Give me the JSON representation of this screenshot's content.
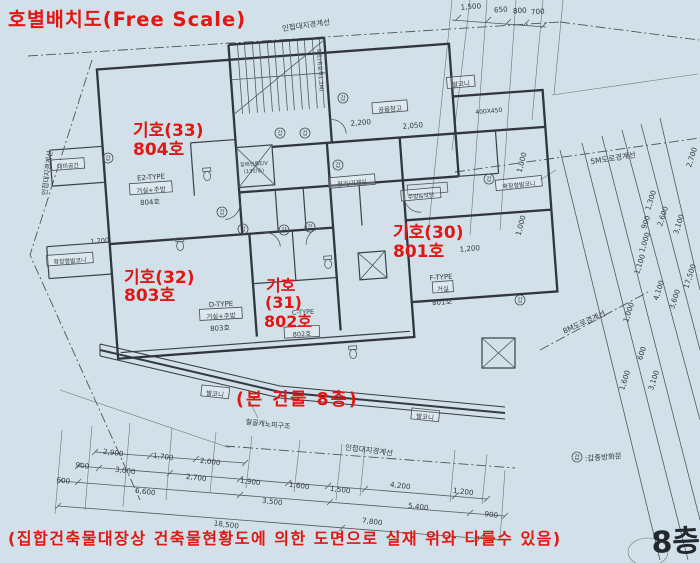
{
  "page": {
    "title": "호별배치도(Free Scale)",
    "floor_stamp": "8층",
    "disclaimer": "(집합건축물대장상 건축물현황도에 의한 도면으로 실재 위와 다를수 있음)",
    "building_note": "(본 건물 8층)",
    "colors": {
      "background": "#d2e0e9",
      "ink": "#30363c",
      "red": "#e01713"
    }
  },
  "red_notes": {
    "unit33": {
      "lines": [
        "기호(33)",
        "804호"
      ]
    },
    "unit30": {
      "lines": [
        "기호(30)",
        "801호"
      ]
    },
    "unit32": {
      "lines": [
        "기호(32)",
        "803호"
      ]
    },
    "unit31": {
      "lines": [
        "기호",
        "(31)",
        "802호"
      ]
    }
  },
  "site": {
    "legend_mark": "갑",
    "legend_text": ":갑종방화문",
    "door_mark": "갑"
  },
  "generated": {
    "labels": [
      {
        "t": "발코니",
        "x": 461,
        "y": 84,
        "r": -5,
        "box": 1,
        "fs": 6.5
      },
      {
        "t": "발코니",
        "x": 215,
        "y": 394,
        "r": 6,
        "box": 1,
        "fs": 6.5
      },
      {
        "t": "발코니",
        "x": 425,
        "y": 417,
        "r": 6,
        "box": 1,
        "fs": 6.5
      },
      {
        "t": "공용창고",
        "x": 390,
        "y": 109,
        "r": -5,
        "box": 1,
        "fs": 6.5
      },
      {
        "t": "대피공간",
        "x": 68,
        "y": 166,
        "r": -4,
        "box": 1,
        "fs": 6
      },
      {
        "t": "확장형발코니",
        "x": 70,
        "y": 261,
        "r": -4,
        "box": 1,
        "fs": 6
      },
      {
        "t": "확장형발코니",
        "x": 519,
        "y": 185,
        "r": -6,
        "box": 1,
        "fs": 6
      },
      {
        "t": "주방&식당",
        "x": 421,
        "y": 196,
        "r": -5,
        "box": 1,
        "fs": 6
      },
      {
        "t": "전기/기계실",
        "x": 352,
        "y": 183,
        "r": -5,
        "box": 1,
        "fs": 6
      },
      {
        "t": "E2-TYPE",
        "x": 151,
        "y": 177,
        "r": -4,
        "fs": 7
      },
      {
        "t": "거실+주방",
        "x": 151,
        "y": 190,
        "r": -4,
        "box": 1,
        "fs": 6.5
      },
      {
        "t": "804호",
        "x": 150,
        "y": 202,
        "r": -4,
        "fs": 7
      },
      {
        "t": "D-TYPE",
        "x": 221,
        "y": 304,
        "r": -3,
        "fs": 7
      },
      {
        "t": "거실+주방",
        "x": 221,
        "y": 316,
        "r": -3,
        "box": 1,
        "fs": 6.5
      },
      {
        "t": "803호",
        "x": 220,
        "y": 328,
        "r": -3,
        "fs": 7
      },
      {
        "t": "C-TYPE",
        "x": 303,
        "y": 312,
        "r": -3,
        "fs": 6.5
      },
      {
        "t": "802호",
        "x": 302,
        "y": 334,
        "r": -3,
        "box": 1,
        "fs": 6.5
      },
      {
        "t": "F-TYPE",
        "x": 441,
        "y": 277,
        "r": -4,
        "fs": 7
      },
      {
        "t": "거실",
        "x": 443,
        "y": 289,
        "r": -4,
        "box": 1,
        "fs": 6.5
      },
      {
        "t": "801호",
        "x": 442,
        "y": 302,
        "r": -4,
        "fs": 7
      },
      {
        "t": "장애인용E/V",
        "x": 254,
        "y": 164,
        "r": -4,
        "fs": 5.2
      },
      {
        "t": "(13인승)",
        "x": 254,
        "y": 171,
        "r": -4,
        "fs": 5.2
      },
      {
        "t": "복도(유효폭1.2M)",
        "x": 320,
        "y": 70,
        "r": 86,
        "fs": 5.5
      },
      {
        "t": "인접대지경계선",
        "x": 306,
        "y": 25,
        "r": -8,
        "fs": 7.5
      },
      {
        "t": "인접대지경계선",
        "x": 47,
        "y": 173,
        "r": -83,
        "fs": 7
      },
      {
        "t": "인접대지경계선",
        "x": 369,
        "y": 450,
        "r": 7,
        "fs": 7.5
      },
      {
        "t": "5M도로경계선",
        "x": 613,
        "y": 158,
        "r": -9,
        "fs": 7.5
      },
      {
        "t": "8M도로경계선",
        "x": 584,
        "y": 322,
        "r": -24,
        "fs": 7.5
      },
      {
        "t": "철골캐노피구조",
        "x": 268,
        "y": 424,
        "r": 6,
        "fs": 7
      }
    ],
    "dims": [
      {
        "t": "1,500",
        "x": 471,
        "y": 9,
        "r": -4
      },
      {
        "t": "650",
        "x": 501,
        "y": 12,
        "r": -4
      },
      {
        "t": "800",
        "x": 520,
        "y": 13,
        "r": -4
      },
      {
        "t": "700",
        "x": 538,
        "y": 14,
        "r": -4
      },
      {
        "t": "2,200",
        "x": 361,
        "y": 125,
        "r": -5
      },
      {
        "t": "2,050",
        "x": 413,
        "y": 128,
        "r": -5
      },
      {
        "t": "400X450",
        "x": 489,
        "y": 113,
        "r": -5,
        "fs": 6
      },
      {
        "t": "1,000",
        "x": 524,
        "y": 163,
        "r": -75
      },
      {
        "t": "1,000",
        "x": 523,
        "y": 226,
        "r": -75
      },
      {
        "t": "1,200",
        "x": 470,
        "y": 251,
        "r": -5
      },
      {
        "t": "1,200",
        "x": 100,
        "y": 243,
        "r": -5,
        "fs": 6.5
      },
      {
        "t": "2,900",
        "x": 113,
        "y": 455,
        "r": 7
      },
      {
        "t": "1,700",
        "x": 163,
        "y": 459,
        "r": 7
      },
      {
        "t": "2,000",
        "x": 210,
        "y": 464,
        "r": 7
      },
      {
        "t": "900",
        "x": 82,
        "y": 468,
        "r": 7
      },
      {
        "t": "3,000",
        "x": 125,
        "y": 473,
        "r": 7
      },
      {
        "t": "2,700",
        "x": 196,
        "y": 480,
        "r": 7
      },
      {
        "t": "1,900",
        "x": 250,
        "y": 484,
        "r": 7
      },
      {
        "t": "1,600",
        "x": 299,
        "y": 488,
        "r": 7
      },
      {
        "t": "1,500",
        "x": 340,
        "y": 492,
        "r": 7
      },
      {
        "t": "4,200",
        "x": 400,
        "y": 488,
        "r": 7
      },
      {
        "t": "1,200",
        "x": 463,
        "y": 494,
        "r": 7
      },
      {
        "t": "600",
        "x": 63,
        "y": 483,
        "r": 7
      },
      {
        "t": "6,600",
        "x": 145,
        "y": 494,
        "r": 7
      },
      {
        "t": "3,500",
        "x": 272,
        "y": 504,
        "r": 7
      },
      {
        "t": "5,400",
        "x": 418,
        "y": 509,
        "r": 7
      },
      {
        "t": "900",
        "x": 491,
        "y": 517,
        "r": 7
      },
      {
        "t": "18,500",
        "x": 226,
        "y": 527,
        "r": 7
      },
      {
        "t": "7,800",
        "x": 372,
        "y": 524,
        "r": 7
      },
      {
        "t": "2,700",
        "x": 694,
        "y": 158,
        "r": -72
      },
      {
        "t": "1,300",
        "x": 653,
        "y": 201,
        "r": -72
      },
      {
        "t": "900",
        "x": 648,
        "y": 223,
        "r": -72
      },
      {
        "t": "2,600",
        "x": 665,
        "y": 217,
        "r": -72
      },
      {
        "t": "3,100",
        "x": 681,
        "y": 225,
        "r": -72
      },
      {
        "t": "1,000",
        "x": 647,
        "y": 243,
        "r": -72
      },
      {
        "t": "1,100",
        "x": 642,
        "y": 265,
        "r": -72
      },
      {
        "t": "17,500",
        "x": 692,
        "y": 277,
        "r": -72
      },
      {
        "t": "4,100",
        "x": 661,
        "y": 291,
        "r": -72
      },
      {
        "t": "3,600",
        "x": 677,
        "y": 300,
        "r": -72
      },
      {
        "t": "1,000",
        "x": 631,
        "y": 313,
        "r": -72
      },
      {
        "t": "600",
        "x": 644,
        "y": 354,
        "r": -72
      },
      {
        "t": "1,600",
        "x": 627,
        "y": 381,
        "r": -72
      },
      {
        "t": "3,100",
        "x": 656,
        "y": 381,
        "r": -72
      }
    ],
    "door_markers": [
      [
        108,
        158
      ],
      [
        343,
        98
      ],
      [
        305,
        133
      ],
      [
        280,
        133
      ],
      [
        338,
        165
      ],
      [
        222,
        212
      ],
      [
        243,
        229
      ],
      [
        284,
        230
      ],
      [
        310,
        227
      ],
      [
        489,
        179
      ],
      [
        520,
        300
      ]
    ]
  }
}
